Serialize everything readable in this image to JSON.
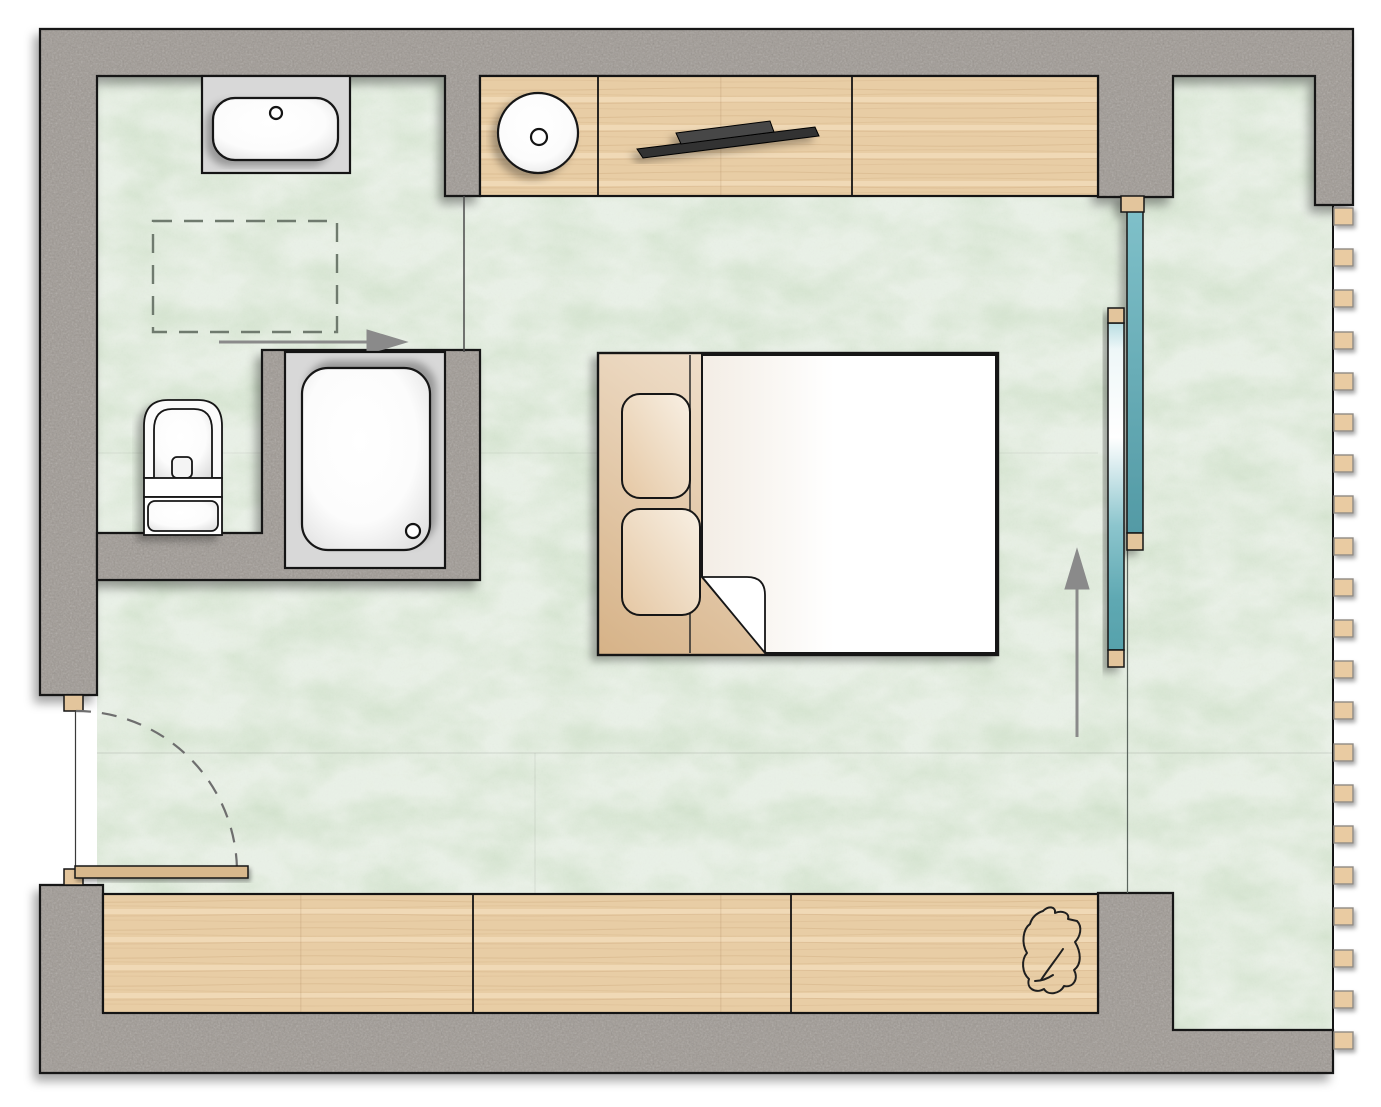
{
  "meta": {
    "label": "bedroom-suite-floor-plan",
    "type": "architectural floor plan, top view",
    "visible_text": []
  },
  "palette": {
    "bg": "#ffffff",
    "wall": "#9e9892",
    "floor": "#cfe0c9",
    "wood": "#e8cda5",
    "wood-slat": "#e9cba2",
    "wood-cap": "#e3c59c",
    "door-leaf": "#d8b88c",
    "glass": "#5fa9b3",
    "surround": "#d8d8d8",
    "fixture": "#ffffff",
    "line": "#141414",
    "arrow": "#8a8a8a",
    "dash": "#6f7a6e",
    "sketch": "#1f1f1f",
    "headboard": "#d9b68f"
  },
  "louvre_screen": {
    "slat_count": 21,
    "x": 1334,
    "y_start": 208,
    "pitch": 41.2,
    "slat_width": 19,
    "slat_height": 17
  },
  "inventory": {
    "counter_sections": 3,
    "bench_sections": 3,
    "bed_pillows": 2,
    "arrows": [
      "right",
      "up"
    ],
    "bath_fixtures": [
      "washbasin",
      "round-basin",
      "toilet",
      "shower"
    ],
    "doors": [
      "hinged-entry-door",
      "sliding-glass-door"
    ]
  }
}
